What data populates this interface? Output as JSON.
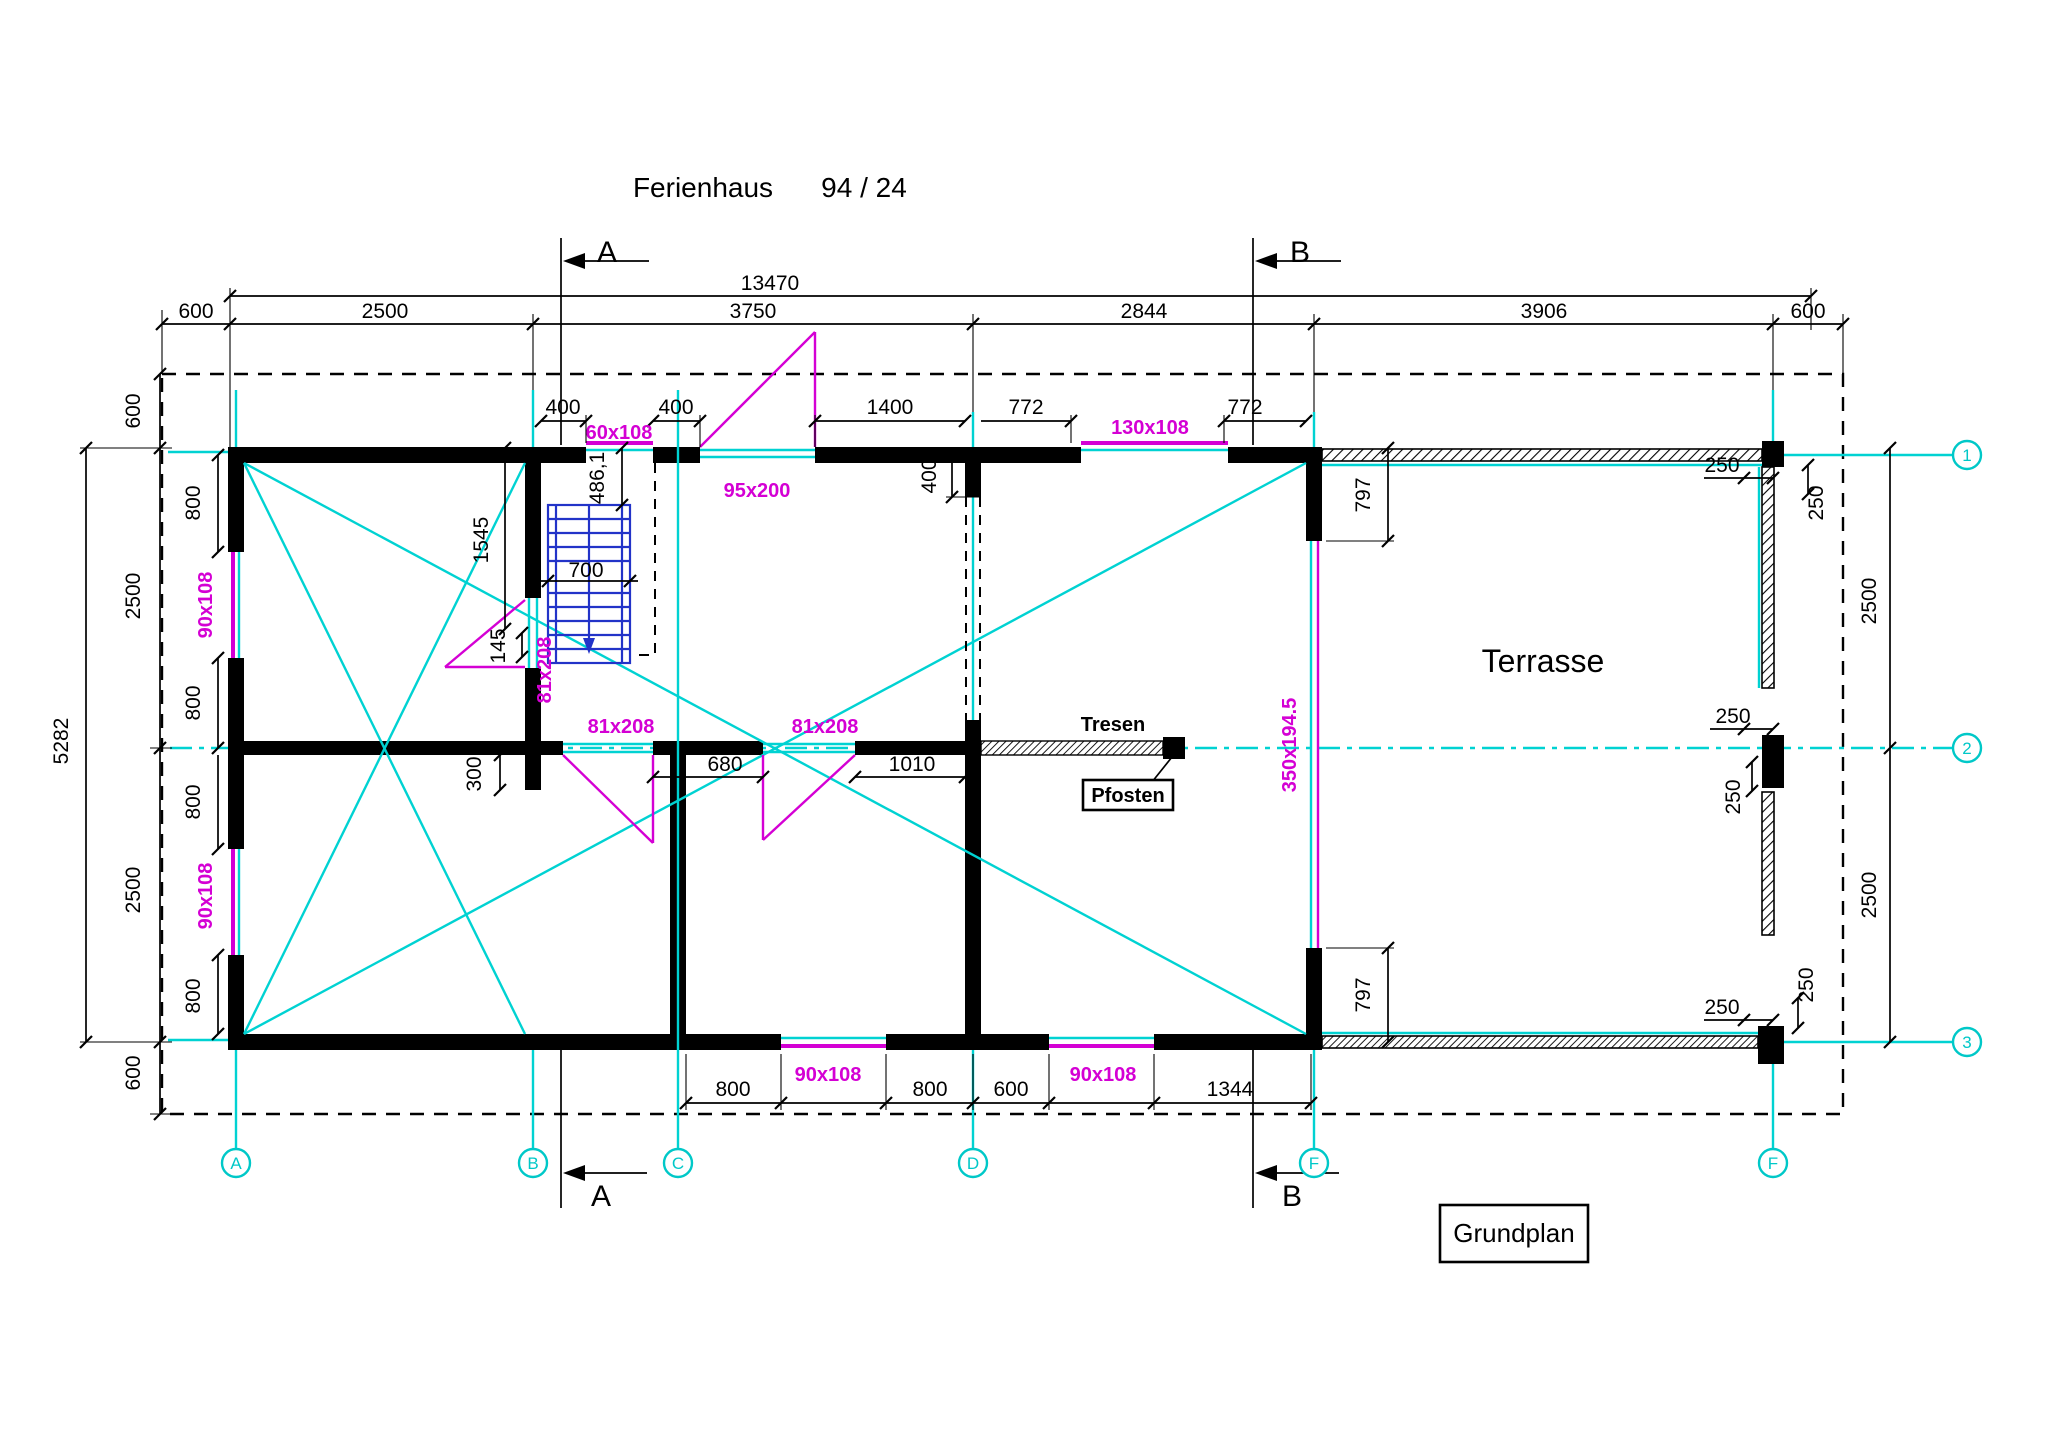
{
  "title": {
    "name": "Ferienhaus",
    "number": "94 / 24"
  },
  "caption": "Grundplan",
  "labels": {
    "terrasse": "Terrasse",
    "tresen": "Tresen",
    "pfosten": "Pfosten"
  },
  "sections": {
    "a": "A",
    "b": "B"
  },
  "grid": {
    "bottom": [
      "A",
      "B",
      "C",
      "D",
      "F",
      "F"
    ],
    "right": [
      "1",
      "2",
      "3"
    ]
  },
  "colors": {
    "grid": "#00d2d2",
    "window": "#d400d4",
    "stairs": "#2233c8",
    "wall": "#000000"
  },
  "dims": {
    "overall": "13470",
    "top": [
      "600",
      "2500",
      "3750",
      "2844",
      "3906",
      "600"
    ],
    "inner_top": [
      "400",
      "400",
      "1400",
      "772",
      "772"
    ],
    "left_total": "5282",
    "left_col": [
      "600",
      "2500",
      "2500",
      "600"
    ],
    "left_wall": [
      "800",
      "800",
      "800",
      "800"
    ],
    "right_col": [
      "2500",
      "2500"
    ],
    "right_250": [
      "250",
      "250",
      "250",
      "250",
      "250",
      "250"
    ],
    "bottom": [
      "800",
      "800",
      "600",
      "1344"
    ],
    "middle": [
      "680",
      "1010"
    ],
    "vert400": "400",
    "d797": [
      "797",
      "797"
    ],
    "stair": {
      "width": "700",
      "run": "1545",
      "top": "486,1",
      "gap": "145",
      "stub": "300"
    }
  },
  "openings": {
    "w60": "60x108",
    "w130": "130x108",
    "entry": "95x200",
    "w90": [
      "90x108",
      "90x108",
      "90x108",
      "90x108"
    ],
    "doors81": [
      "81x208",
      "81x208",
      "81x208"
    ],
    "glazing": "350x194.5"
  }
}
